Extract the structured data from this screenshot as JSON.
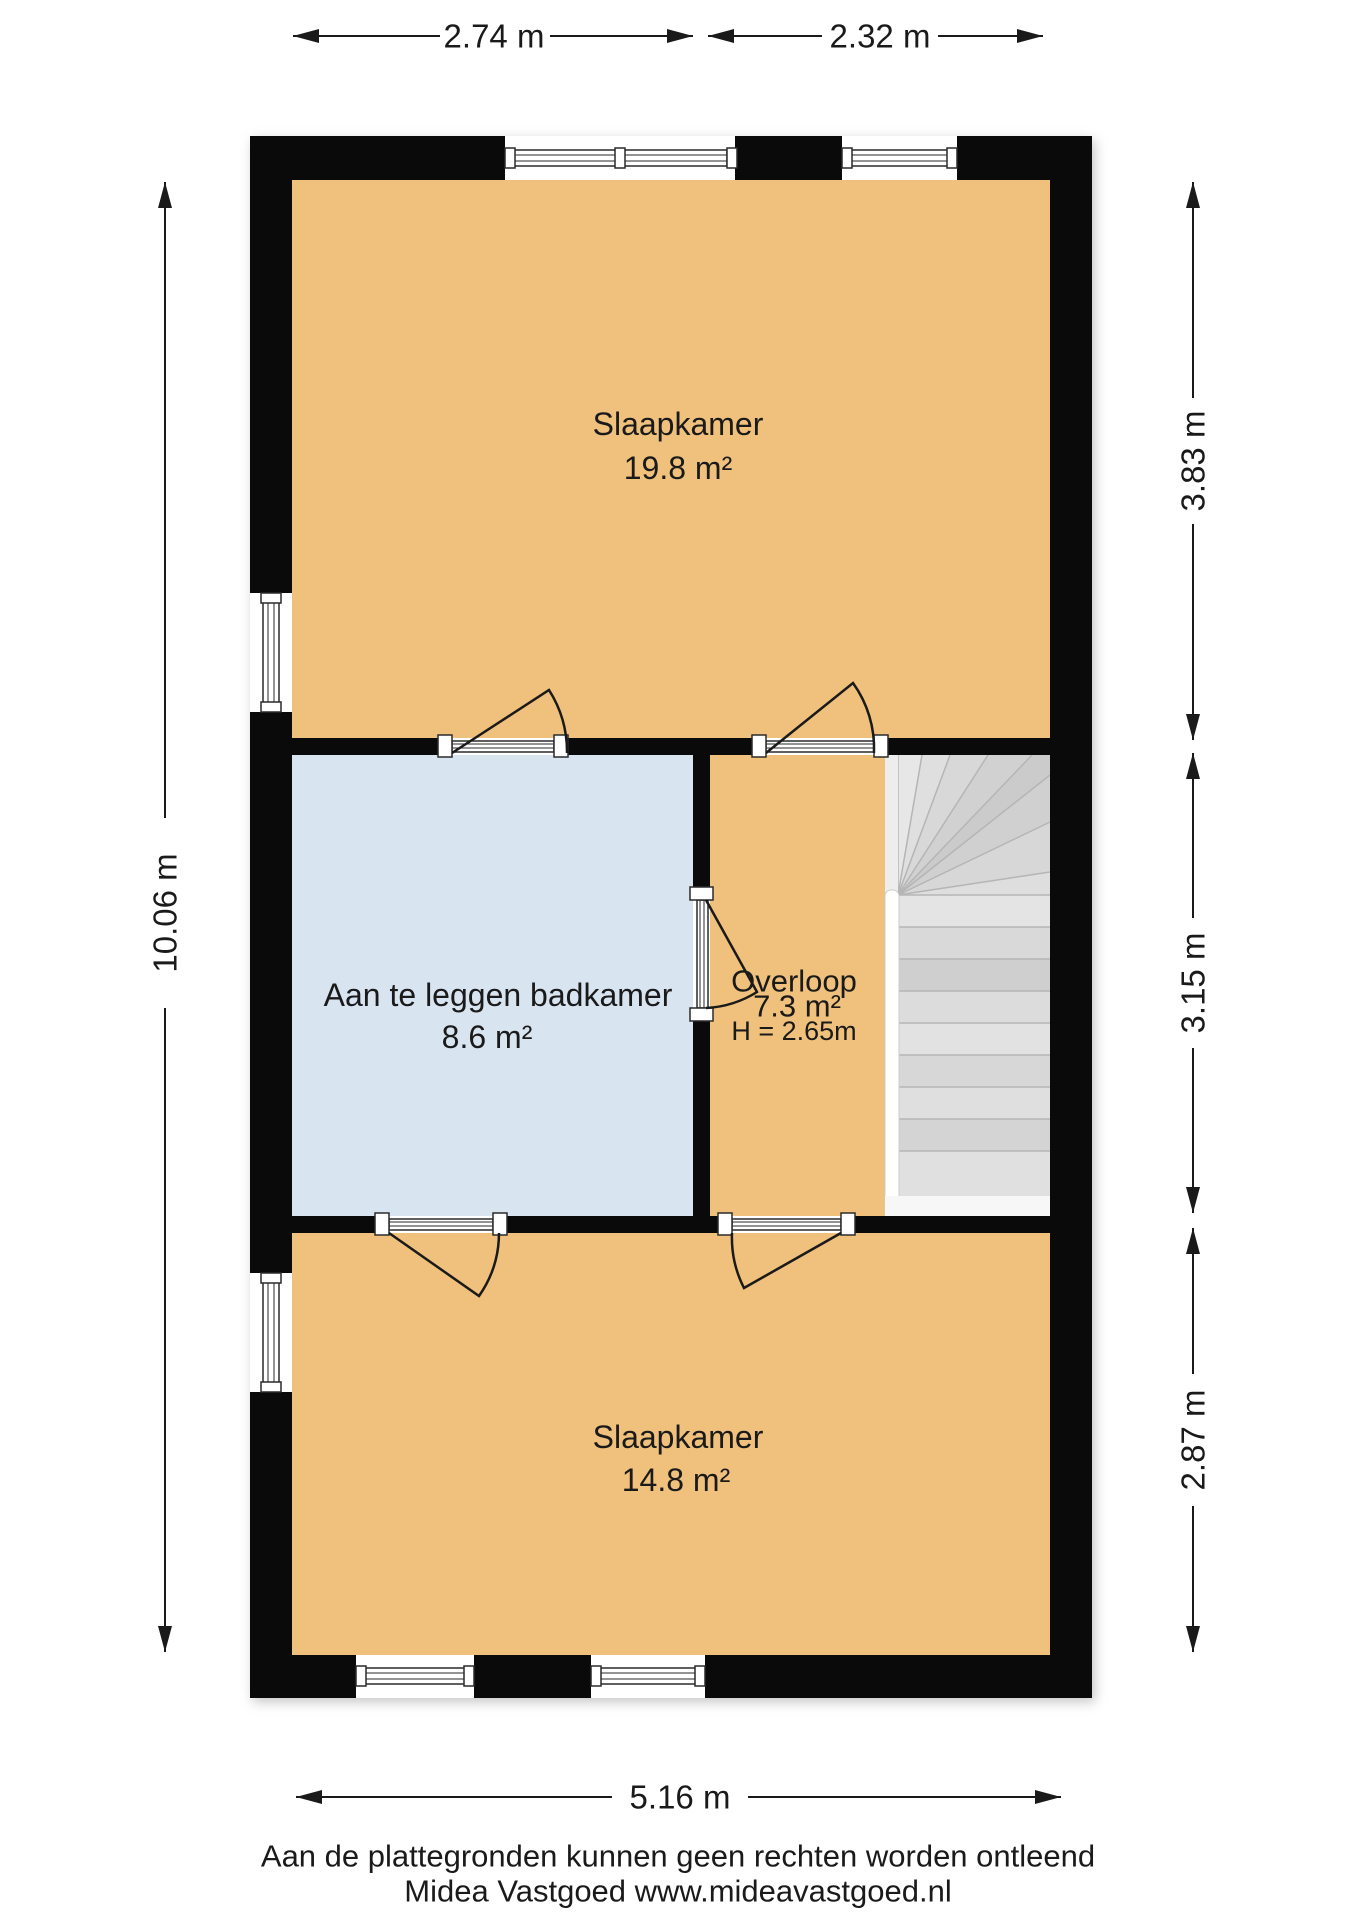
{
  "rooms": [
    {
      "id": "slaapkamer-1",
      "name": "Slaapkamer",
      "area": "19.8 m²"
    },
    {
      "id": "badkamer",
      "name": "Aan te leggen badkamer",
      "area": "8.6 m²"
    },
    {
      "id": "overloop",
      "name": "Overloop",
      "area": "7.3 m²",
      "ceiling_height": "H = 2.65m"
    },
    {
      "id": "slaapkamer-2",
      "name": "Slaapkamer",
      "area": "14.8 m²"
    }
  ],
  "dimensions": {
    "top_left": "2.74 m",
    "top_right": "2.32 m",
    "right_top": "3.83 m",
    "right_middle": "3.15 m",
    "right_bottom": "2.87 m",
    "left": "10.06 m",
    "bottom": "5.16 m"
  },
  "footer": {
    "disclaimer": "Aan de plattegronden kunnen geen rechten worden ontleend",
    "agency": "Midea Vastgoed www.mideavastgoed.nl"
  },
  "colors": {
    "room_orange": "#f0c17c",
    "room_blue": "#d9e4f1",
    "stairs_gray": "#dcdcdc",
    "wall_black": "#0a0a0a"
  }
}
